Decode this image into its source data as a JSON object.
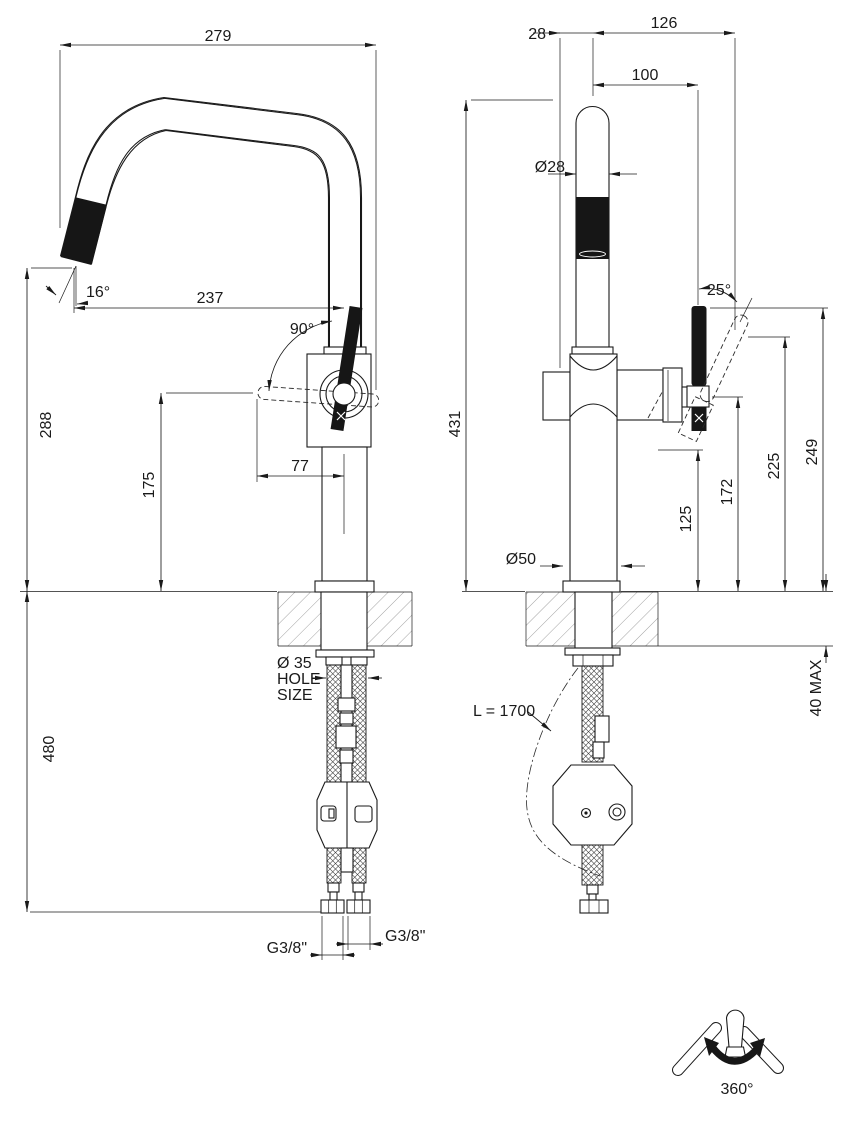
{
  "colors": {
    "line": "#1a1a1a",
    "fill": "#ffffff"
  },
  "side_view": {
    "reach": "279",
    "tip_to_axis": "237",
    "tip_angle": "16°",
    "handle_swing": "90°",
    "tip_height": "288",
    "handle_height": "175",
    "handle_length": "77",
    "under_counter_drop": "480",
    "hole_note": {
      "l1": "Ø 35",
      "l2": "HOLE",
      "l3": "SIZE"
    },
    "conn_left": "G3/8\"",
    "conn_right": "G3/8\""
  },
  "front_view": {
    "body_offset": "28",
    "handle_reach": "126",
    "handle_offset": "100",
    "spout_diameter": "Ø28",
    "handle_tilt": "25°",
    "total_height": "431",
    "handle_top_height": "249",
    "handle_mid_height": "225",
    "pivot_height": "172",
    "handle_low_height": "125",
    "base_diameter": "Ø50",
    "counter_thickness": "40 MAX",
    "hose_length": "L = 1700"
  },
  "rotation_note": {
    "angle": "360°"
  }
}
